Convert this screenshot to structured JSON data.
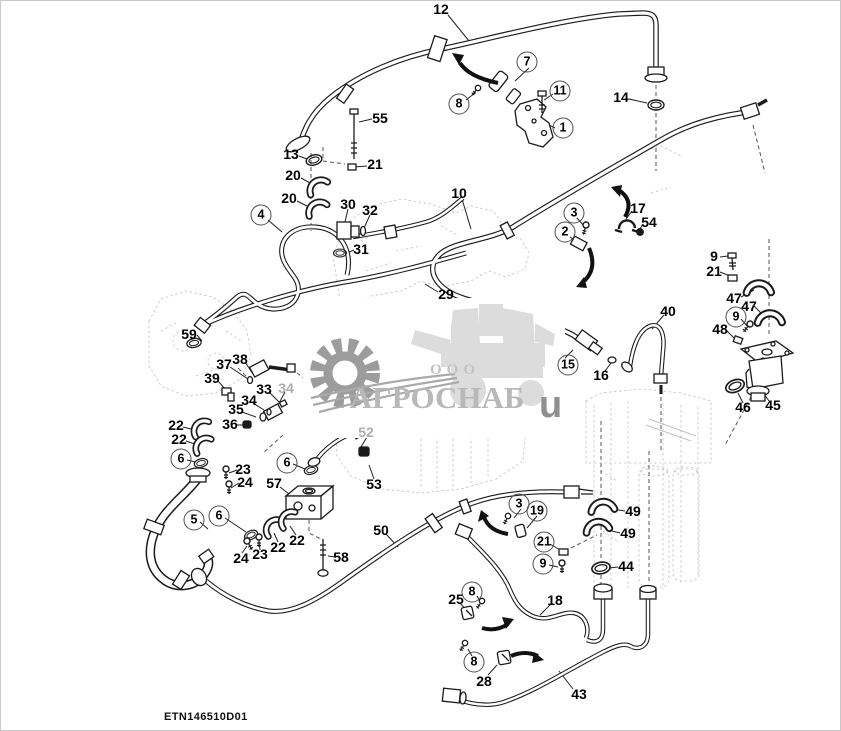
{
  "page": {
    "background": "#ffffff",
    "footer_code": "ETN146510D01"
  },
  "watermark": {
    "company_prefix": "ООО",
    "company_name": "АГРОСНАБ",
    "suffix_letter": "u",
    "gear_icon": "gear-icon",
    "machine_icon": "combine-harvester-icon",
    "gear_color": "#9c9c9c",
    "machine_color": "#dcdcdc",
    "text_color": "#b8b8b8"
  },
  "diagram": {
    "line_color": "#1a1a1a",
    "dash_color": "#6e6e6e",
    "label_color": "#000000",
    "faded_label_color": "#adadad",
    "part_labels": [
      {
        "n": "12",
        "x": 440,
        "y": 8,
        "circled": false,
        "faded": false
      },
      {
        "n": "7",
        "x": 526,
        "y": 61,
        "circled": true,
        "faded": false
      },
      {
        "n": "8",
        "x": 458,
        "y": 103,
        "circled": true,
        "faded": false
      },
      {
        "n": "11",
        "x": 559,
        "y": 90,
        "circled": true,
        "faded": false
      },
      {
        "n": "1",
        "x": 562,
        "y": 127,
        "circled": true,
        "faded": false
      },
      {
        "n": "14",
        "x": 620,
        "y": 96,
        "circled": false,
        "faded": false
      },
      {
        "n": "55",
        "x": 379,
        "y": 117,
        "circled": false,
        "faded": false
      },
      {
        "n": "13",
        "x": 290,
        "y": 153,
        "circled": false,
        "faded": false
      },
      {
        "n": "21",
        "x": 374,
        "y": 163,
        "circled": false,
        "faded": false
      },
      {
        "n": "20",
        "x": 292,
        "y": 174,
        "circled": false,
        "faded": false
      },
      {
        "n": "20",
        "x": 288,
        "y": 197,
        "circled": false,
        "faded": false
      },
      {
        "n": "4",
        "x": 260,
        "y": 214,
        "circled": true,
        "faded": false
      },
      {
        "n": "30",
        "x": 347,
        "y": 203,
        "circled": false,
        "faded": false
      },
      {
        "n": "32",
        "x": 369,
        "y": 209,
        "circled": false,
        "faded": false
      },
      {
        "n": "31",
        "x": 360,
        "y": 248,
        "circled": false,
        "faded": false
      },
      {
        "n": "10",
        "x": 458,
        "y": 192,
        "circled": false,
        "faded": false
      },
      {
        "n": "3",
        "x": 573,
        "y": 212,
        "circled": true,
        "faded": false
      },
      {
        "n": "2",
        "x": 564,
        "y": 231,
        "circled": true,
        "faded": false
      },
      {
        "n": "17",
        "x": 637,
        "y": 207,
        "circled": false,
        "faded": false
      },
      {
        "n": "54",
        "x": 648,
        "y": 221,
        "circled": false,
        "faded": false
      },
      {
        "n": "29",
        "x": 445,
        "y": 293,
        "circled": false,
        "faded": false
      },
      {
        "n": "9",
        "x": 713,
        "y": 255,
        "circled": false,
        "faded": false
      },
      {
        "n": "21",
        "x": 713,
        "y": 270,
        "circled": false,
        "faded": false
      },
      {
        "n": "47",
        "x": 733,
        "y": 297,
        "circled": false,
        "faded": false
      },
      {
        "n": "47",
        "x": 748,
        "y": 305,
        "circled": false,
        "faded": false
      },
      {
        "n": "9",
        "x": 735,
        "y": 316,
        "circled": true,
        "faded": false
      },
      {
        "n": "48",
        "x": 719,
        "y": 328,
        "circled": false,
        "faded": false
      },
      {
        "n": "40",
        "x": 667,
        "y": 310,
        "circled": false,
        "faded": false
      },
      {
        "n": "46",
        "x": 742,
        "y": 406,
        "circled": false,
        "faded": false
      },
      {
        "n": "45",
        "x": 772,
        "y": 404,
        "circled": false,
        "faded": false
      },
      {
        "n": "59",
        "x": 188,
        "y": 333,
        "circled": false,
        "faded": false
      },
      {
        "n": "37",
        "x": 223,
        "y": 363,
        "circled": false,
        "faded": false
      },
      {
        "n": "38",
        "x": 239,
        "y": 358,
        "circled": false,
        "faded": false
      },
      {
        "n": "39",
        "x": 211,
        "y": 377,
        "circled": false,
        "faded": false
      },
      {
        "n": "33",
        "x": 263,
        "y": 388,
        "circled": false,
        "faded": false
      },
      {
        "n": "34",
        "x": 285,
        "y": 387,
        "circled": false,
        "faded": true
      },
      {
        "n": "34",
        "x": 248,
        "y": 399,
        "circled": false,
        "faded": false
      },
      {
        "n": "35",
        "x": 235,
        "y": 408,
        "circled": false,
        "faded": false
      },
      {
        "n": "36",
        "x": 229,
        "y": 423,
        "circled": false,
        "faded": false
      },
      {
        "n": "22",
        "x": 175,
        "y": 424,
        "circled": false,
        "faded": false
      },
      {
        "n": "22",
        "x": 178,
        "y": 438,
        "circled": false,
        "faded": false
      },
      {
        "n": "6",
        "x": 180,
        "y": 458,
        "circled": true,
        "faded": false
      },
      {
        "n": "23",
        "x": 242,
        "y": 468,
        "circled": false,
        "faded": false
      },
      {
        "n": "24",
        "x": 244,
        "y": 481,
        "circled": false,
        "faded": false
      },
      {
        "n": "6",
        "x": 286,
        "y": 462,
        "circled": true,
        "faded": false
      },
      {
        "n": "57",
        "x": 273,
        "y": 482,
        "circled": false,
        "faded": false
      },
      {
        "n": "58",
        "x": 340,
        "y": 556,
        "circled": false,
        "faded": false
      },
      {
        "n": "5",
        "x": 193,
        "y": 519,
        "circled": true,
        "faded": false
      },
      {
        "n": "6",
        "x": 218,
        "y": 515,
        "circled": true,
        "faded": false
      },
      {
        "n": "24",
        "x": 240,
        "y": 557,
        "circled": false,
        "faded": false
      },
      {
        "n": "23",
        "x": 259,
        "y": 553,
        "circled": false,
        "faded": false
      },
      {
        "n": "22",
        "x": 277,
        "y": 546,
        "circled": false,
        "faded": false
      },
      {
        "n": "22",
        "x": 296,
        "y": 539,
        "circled": false,
        "faded": false
      },
      {
        "n": "52",
        "x": 365,
        "y": 431,
        "circled": false,
        "faded": true
      },
      {
        "n": "53",
        "x": 373,
        "y": 483,
        "circled": false,
        "faded": false
      },
      {
        "n": "15",
        "x": 567,
        "y": 364,
        "circled": true,
        "faded": false
      },
      {
        "n": "16",
        "x": 600,
        "y": 374,
        "circled": false,
        "faded": false
      },
      {
        "n": "50",
        "x": 380,
        "y": 529,
        "circled": false,
        "faded": false
      },
      {
        "n": "3",
        "x": 518,
        "y": 503,
        "circled": true,
        "faded": false
      },
      {
        "n": "19",
        "x": 536,
        "y": 510,
        "circled": true,
        "faded": false
      },
      {
        "n": "21",
        "x": 543,
        "y": 541,
        "circled": true,
        "faded": false
      },
      {
        "n": "9",
        "x": 542,
        "y": 563,
        "circled": true,
        "faded": false
      },
      {
        "n": "49",
        "x": 632,
        "y": 510,
        "circled": false,
        "faded": false
      },
      {
        "n": "49",
        "x": 627,
        "y": 532,
        "circled": false,
        "faded": false
      },
      {
        "n": "44",
        "x": 625,
        "y": 565,
        "circled": false,
        "faded": false
      },
      {
        "n": "25",
        "x": 455,
        "y": 598,
        "circled": false,
        "faded": false
      },
      {
        "n": "8",
        "x": 471,
        "y": 591,
        "circled": true,
        "faded": false
      },
      {
        "n": "18",
        "x": 554,
        "y": 599,
        "circled": false,
        "faded": false
      },
      {
        "n": "8",
        "x": 473,
        "y": 661,
        "circled": true,
        "faded": false
      },
      {
        "n": "28",
        "x": 483,
        "y": 680,
        "circled": false,
        "faded": false
      },
      {
        "n": "43",
        "x": 578,
        "y": 693,
        "circled": false,
        "faded": false
      }
    ]
  }
}
